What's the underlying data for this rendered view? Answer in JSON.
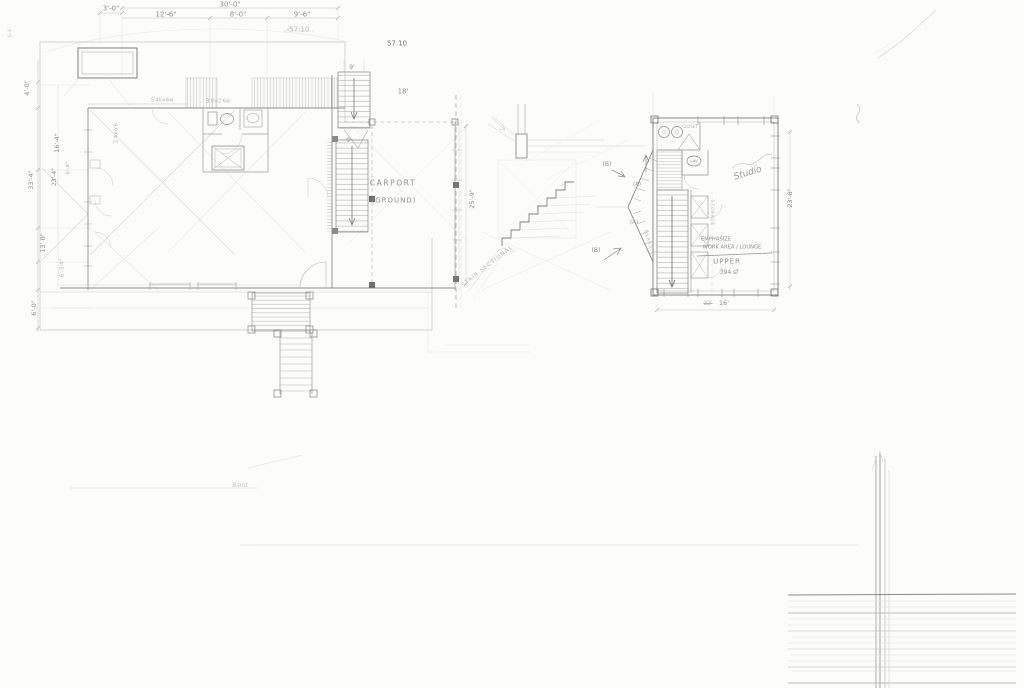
{
  "canvas": {
    "paper_color": "#fcfcfa",
    "pencil_light": "#c8c8c6",
    "pencil_mid": "#9a9a98",
    "pencil_dark": "#6f6f6d"
  },
  "ground_plan": {
    "title": "CARPORT",
    "subtitle": "(GROUND)",
    "dims_top": [
      "3'-0\"",
      "12'-6\"",
      "30'-0\"",
      "8'-0\"",
      "9'-6\""
    ],
    "elevation_notes": [
      "-57:10",
      "57.10"
    ],
    "dims_left": [
      "4'-0\"",
      "16'-4\"",
      "23'-4\"",
      "6'-4\"",
      "33'-4\"",
      "13'-0\"",
      "6'-3.4\"",
      "6'-0\""
    ],
    "dims_right": [
      "25'-9\""
    ],
    "stair_labels": [
      "9'",
      "9'"
    ],
    "carport_width": "18'",
    "window_notes": [
      "5'4h×6w",
      "3'8×2'6w",
      "5'4×6'6"
    ],
    "corner_note": "6-4",
    "basement_note": "Bsmt"
  },
  "stair_section": {
    "label": "STAIR SECTIONAL"
  },
  "upper_plan": {
    "room_label": "Studio",
    "closet_label": "CLOSET",
    "lav_label": "LAV",
    "storage_label": "STORAGE",
    "bay_label": "GLASS",
    "marker_b_top": "(B)",
    "marker_a_top": "(A)",
    "marker_a_bottom": "(A)",
    "marker_b_bottom": "(B)",
    "note_line1": "EMPHASIZE",
    "note_line2": "WORK AREA / LOUNGE",
    "note_line3": "UPPER",
    "note_area": "394 sf",
    "dim_bottom_crossed": "32'",
    "dim_bottom": "16'",
    "dim_right": "23'-8\""
  }
}
